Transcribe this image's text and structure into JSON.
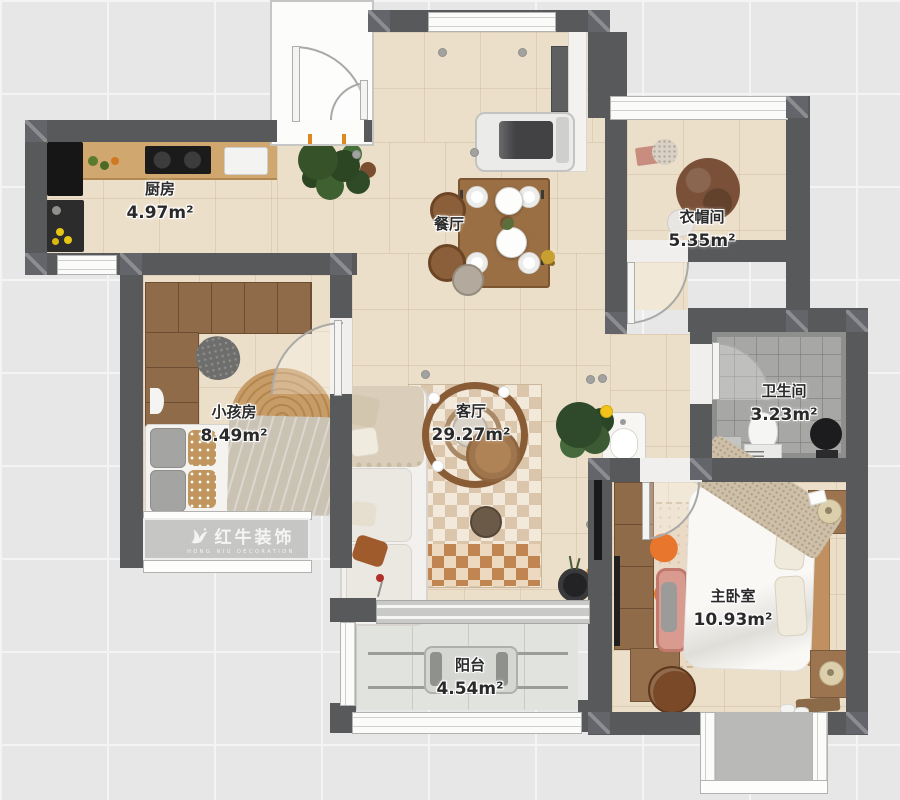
{
  "watermark": {
    "brand": "红牛装饰",
    "brand_en": "HONG NIU DECORATION"
  },
  "rooms": {
    "kitchen": {
      "name": "厨房",
      "area": "4.97m²"
    },
    "dining": {
      "name": "餐厅",
      "area": ""
    },
    "cloakroom": {
      "name": "衣帽间",
      "area": "5.35m²"
    },
    "kids_room": {
      "name": "小孩房",
      "area": "8.49m²"
    },
    "living_room": {
      "name": "客厅",
      "area": "29.27m²"
    },
    "bathroom": {
      "name": "卫生间",
      "area": "3.23m²"
    },
    "master_bedroom": {
      "name": "主卧室",
      "area": "10.93m²"
    },
    "balcony": {
      "name": "阳台",
      "area": "4.54m²"
    }
  },
  "colors": {
    "wall": "#57595b",
    "floor_tile": "#ecdfca",
    "bathroom_tile": "#a7a7a5",
    "balcony_floor": "#e1e3df",
    "wood": "#9a6f45",
    "accent_orange": "#e07a30",
    "watermark_text": "rgba(255,255,255,0.82)"
  }
}
